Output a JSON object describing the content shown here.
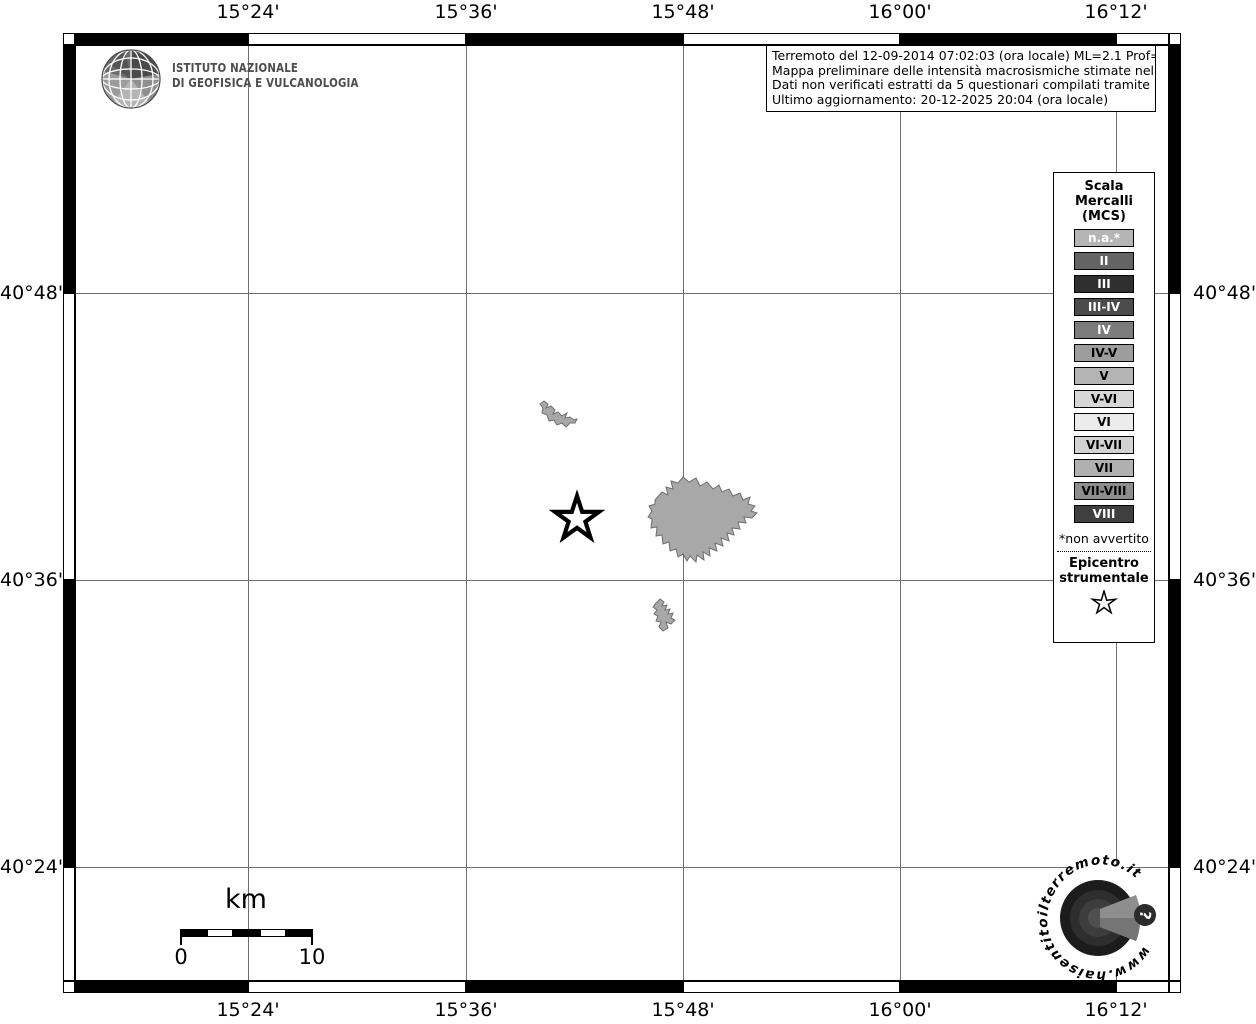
{
  "title_block": {
    "lines": [
      "Terremoto del 12-09-2014 07:02:03 (ora locale) ML=2.1 Prof=9 km",
      "Mappa preliminare delle intensità macrosismiche stimate nelle località",
      "Dati non verificati estratti da 5 questionari compilati tramite Internet.",
      "Ultimo aggiornamento: 20-12-2025 20:04 (ora locale)"
    ]
  },
  "ingv": {
    "name_line1": "ISTITUTO NAZIONALE",
    "name_line2": "DI GEOFISICA E VULCANOLOGIA"
  },
  "axis": {
    "top": [
      "15°24'",
      "15°36'",
      "15°48'",
      "16°00'",
      "16°12'"
    ],
    "bottom": [
      "15°24'",
      "15°36'",
      "15°48'",
      "16°00'",
      "16°12'"
    ],
    "left": [
      "40°48'",
      "40°36'",
      "40°24'"
    ],
    "right": [
      "40°48'",
      "40°36'",
      "40°24'"
    ]
  },
  "legend": {
    "title_lines": [
      "Scala",
      "Mercalli",
      "(MCS)"
    ],
    "items": [
      {
        "label": "n.a.*",
        "bg": "#b5b5b5",
        "fg": "#ffffff"
      },
      {
        "label": "II",
        "bg": "#646464",
        "fg": "#ffffff"
      },
      {
        "label": "III",
        "bg": "#2f2f2f",
        "fg": "#ffffff"
      },
      {
        "label": "III-IV",
        "bg": "#4b4b4b",
        "fg": "#ffffff"
      },
      {
        "label": "IV",
        "bg": "#7b7b7b",
        "fg": "#ffffff"
      },
      {
        "label": "IV-V",
        "bg": "#9d9d9d",
        "fg": "#000000"
      },
      {
        "label": "V",
        "bg": "#b4b4b4",
        "fg": "#000000"
      },
      {
        "label": "V-VI",
        "bg": "#d7d7d7",
        "fg": "#000000"
      },
      {
        "label": "VI",
        "bg": "#ececec",
        "fg": "#000000"
      },
      {
        "label": "VI-VII",
        "bg": "#d2d2d2",
        "fg": "#000000"
      },
      {
        "label": "VII",
        "bg": "#b0b0b0",
        "fg": "#000000"
      },
      {
        "label": "VII-VIII",
        "bg": "#8d8d8d",
        "fg": "#000000"
      },
      {
        "label": "VIII",
        "bg": "#3f3f3f",
        "fg": "#ffffff"
      }
    ],
    "footnote": "*non avvertito",
    "epicenter_label_lines": [
      "Epicentro",
      "strumentale"
    ]
  },
  "scalebar": {
    "unit": "km",
    "start_label": "0",
    "end_label": "10"
  },
  "site_logo": {
    "circular_text": "www.haisentitoilterremoto.it",
    "badge": "?"
  },
  "colors": {
    "grid_line": "#6e6e6e",
    "locality_fill": "#a8a8a8",
    "locality_stroke": "#6f6f6f",
    "frame_black": "#000000",
    "frame_white": "#ffffff"
  }
}
